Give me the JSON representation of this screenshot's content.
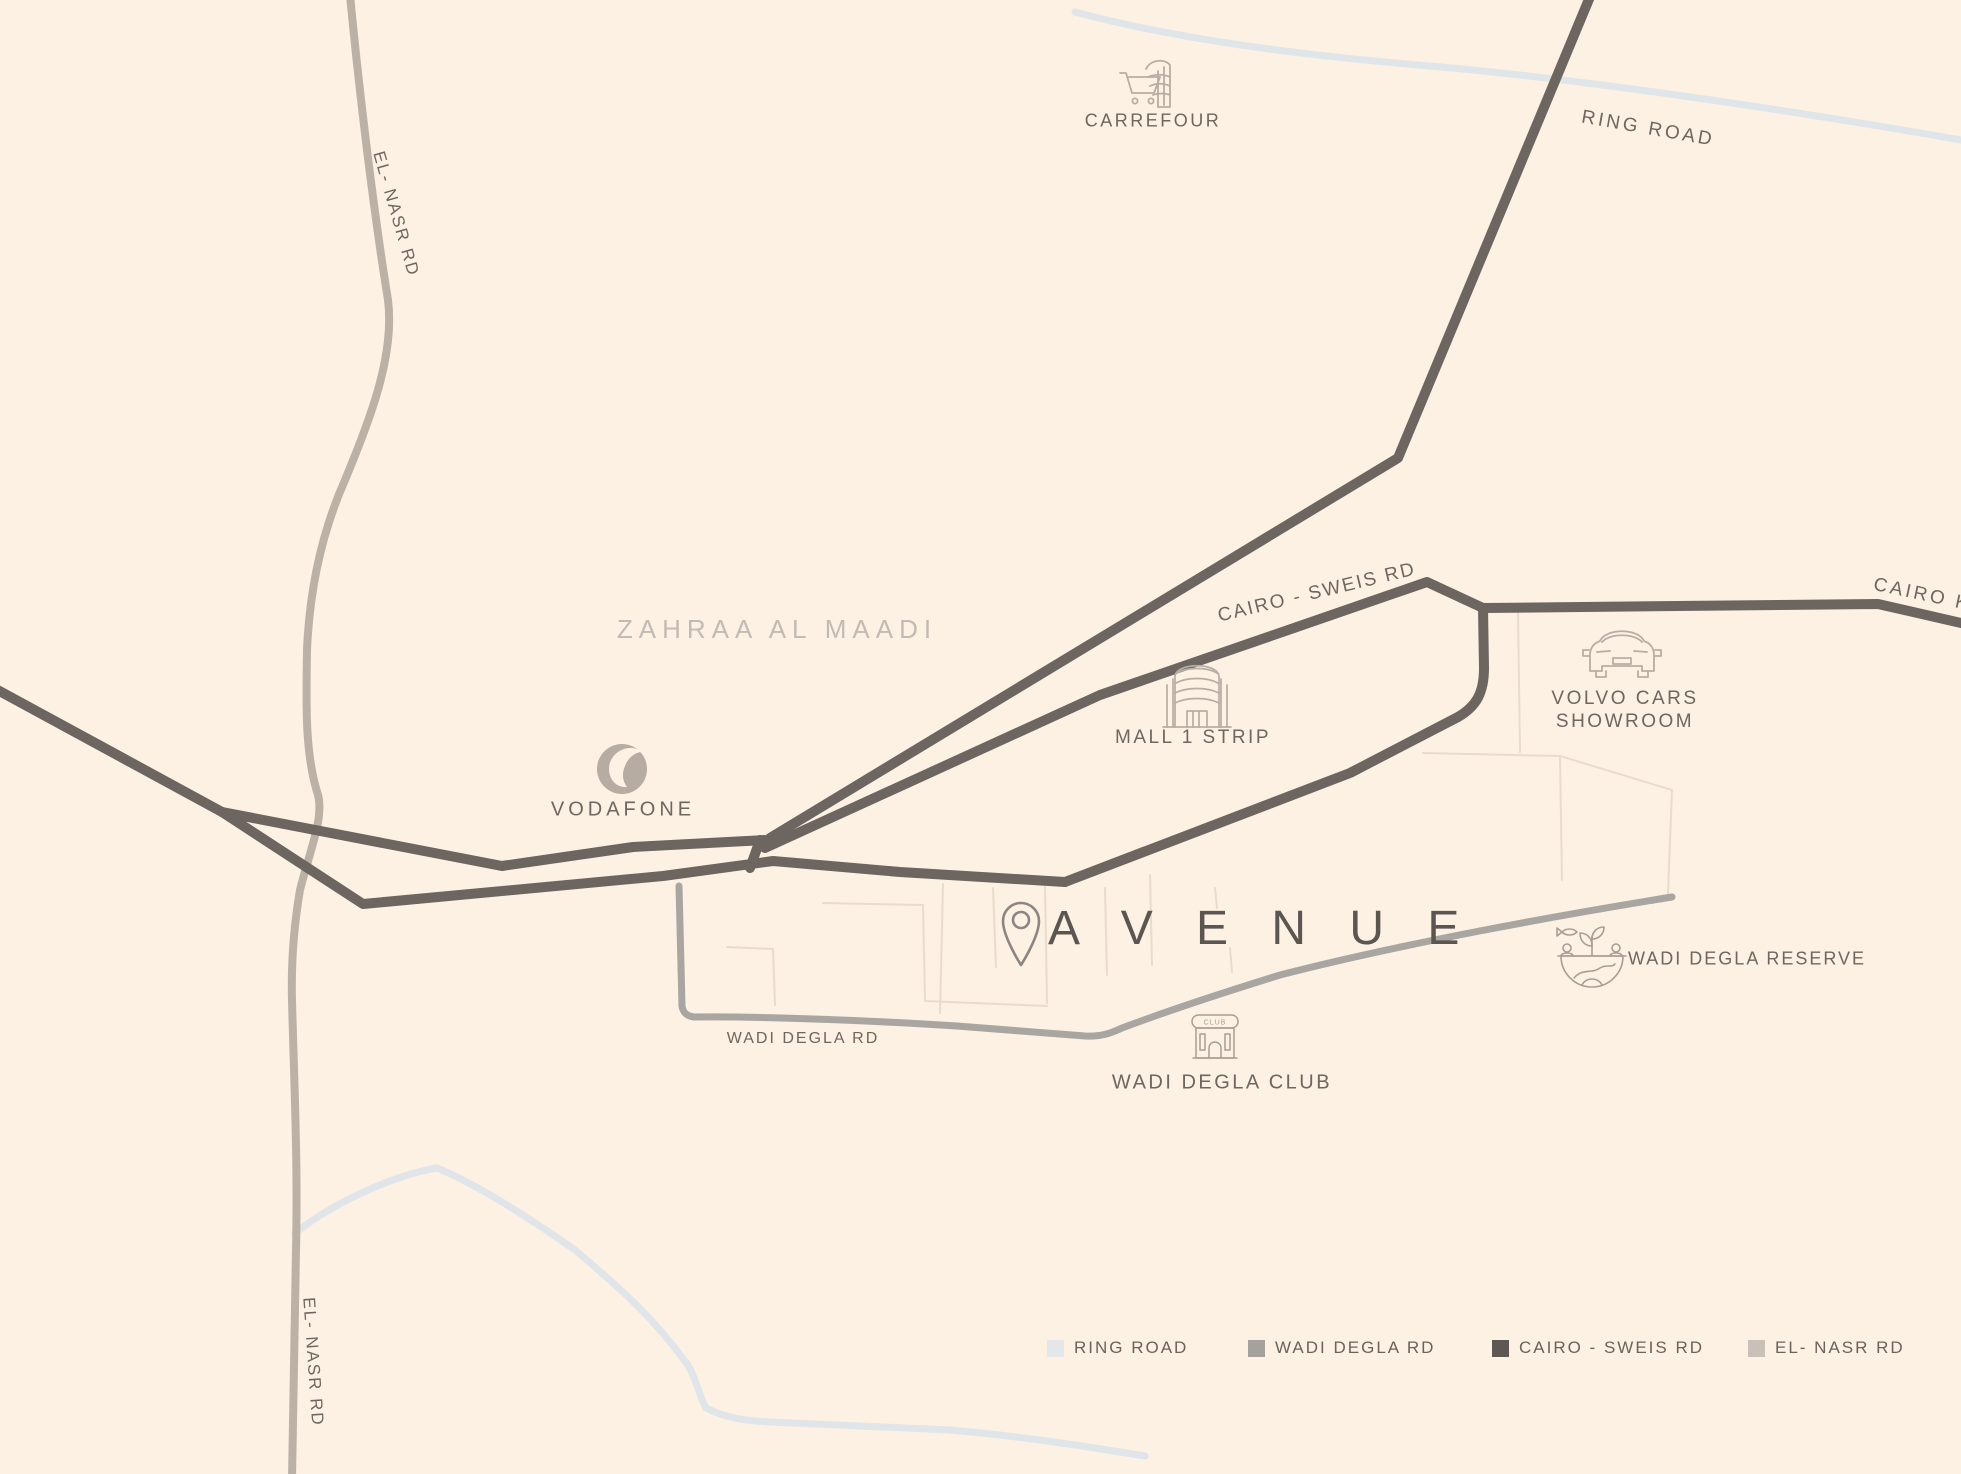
{
  "district_label": "ZAHRAA AL MAADI",
  "project": {
    "name": "A V E N U E"
  },
  "pois": {
    "carrefour": {
      "label": "CARREFOUR"
    },
    "mall": {
      "label": "MALL 1 STRIP"
    },
    "volvo": {
      "line1": "VOLVO CARS",
      "line2": "SHOWROOM"
    },
    "vodafone": {
      "label": "VODAFONE"
    },
    "reserve": {
      "label": "WADI DEGLA RESERVE"
    },
    "club": {
      "label": "WADI DEGLA CLUB",
      "icon_text": "CLUB"
    }
  },
  "roads": {
    "ring": {
      "label": "RING ROAD",
      "color": "#e0e5ea"
    },
    "cairo_sweis": {
      "label": "CAIRO - SWEIS RD",
      "color": "#6c6560"
    },
    "cairo_katameya": {
      "label": "CAIRO KA",
      "color": "#6c6560"
    },
    "el_nasr": {
      "label": "EL- NASR RD",
      "color": "#bbb1a5"
    },
    "wadi_degla": {
      "label": "WADI DEGLA RD",
      "color": "#a9a5a1"
    }
  },
  "legend": [
    {
      "label": "RING ROAD",
      "color": "#e3e7ea"
    },
    {
      "label": "WADI DEGLA RD",
      "color": "#a5a19d"
    },
    {
      "label": "CAIRO - SWEIS RD",
      "color": "#5d5853"
    },
    {
      "label": "EL- NASR RD",
      "color": "#c9c0b8"
    }
  ],
  "colors": {
    "background": "#fcf1e3",
    "label_text": "#6e675f",
    "district_text": "#c2bbb3",
    "project_text": "#5b5650",
    "icon_stroke": "#b7ada2",
    "masterplan_lines": "#eadccc"
  }
}
